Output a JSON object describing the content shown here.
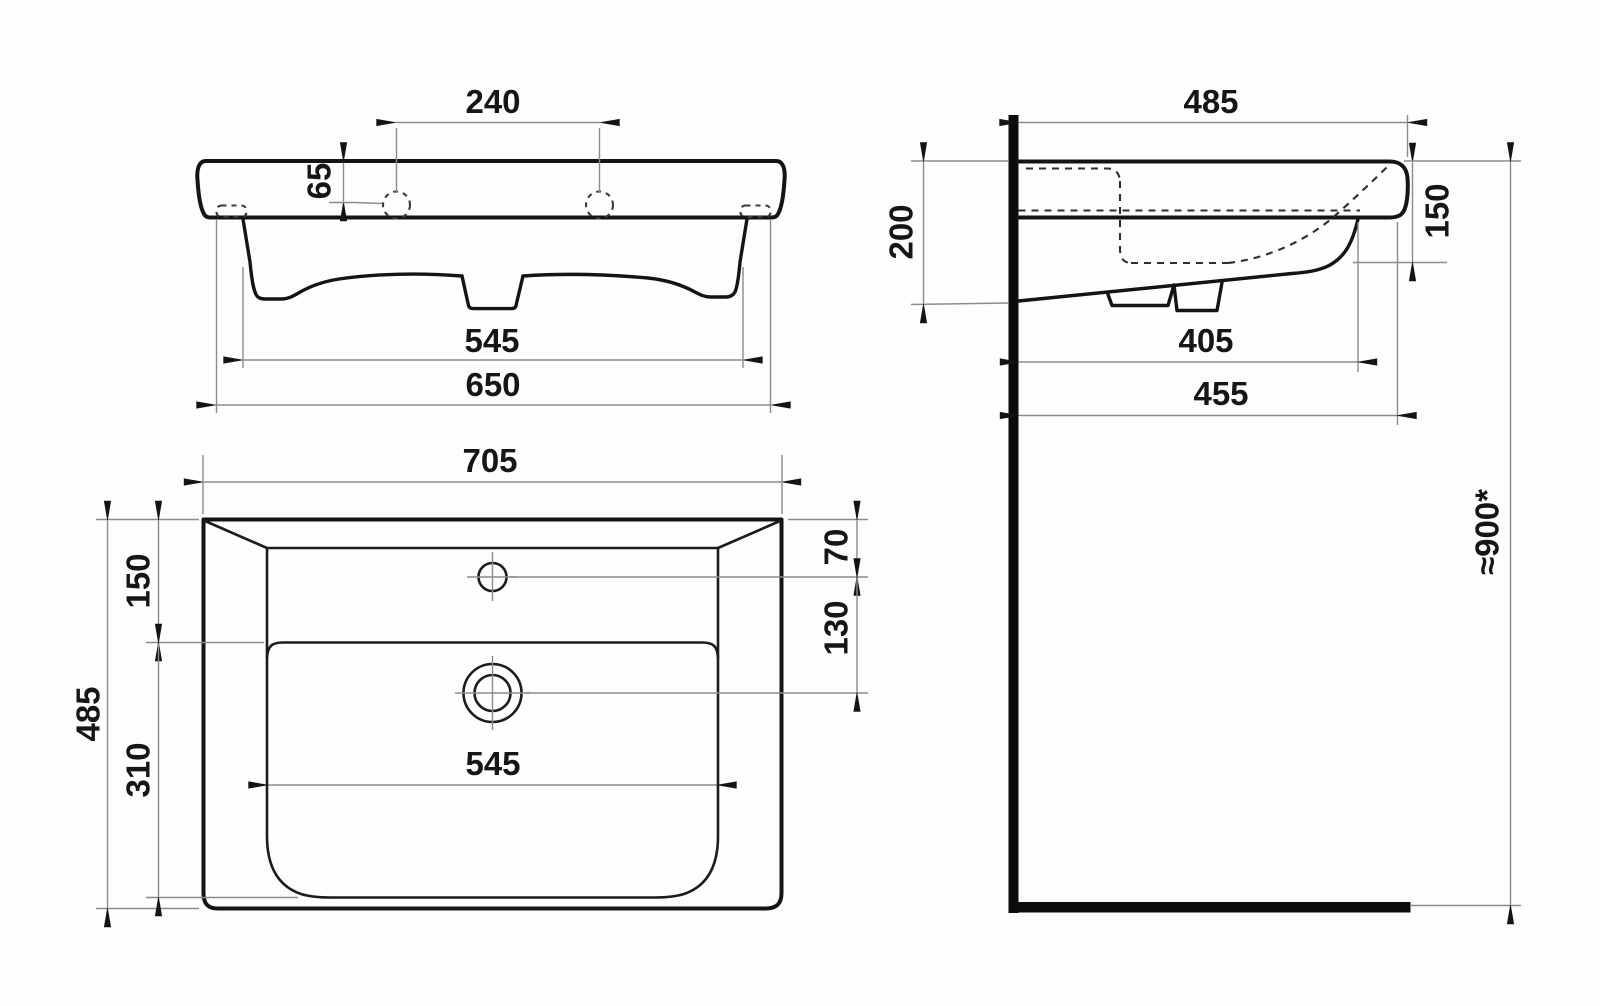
{
  "drawing": {
    "type": "washbasin-installation-dimension-drawing",
    "views": {
      "front": {
        "name": "front-view",
        "dims": {
          "tap_hole_spacing": "240",
          "tap_hole_drop": "65",
          "body_width": "545",
          "fixing_hole_spacing": "650"
        }
      },
      "side": {
        "name": "side-view",
        "dims": {
          "overall_depth": "485",
          "wall_contact_height": "200",
          "front_edge_height": "150",
          "trap_depth": "405",
          "underside_depth": "455",
          "installation_height": "≈900*"
        }
      },
      "plan": {
        "name": "plan-view",
        "dims": {
          "overall_width": "705",
          "deck_to_bowl": "150",
          "bowl_length": "310",
          "overall_depth": "485",
          "tap_from_back": "70",
          "tap_to_drain": "130",
          "bowl_width": "545"
        }
      }
    }
  }
}
